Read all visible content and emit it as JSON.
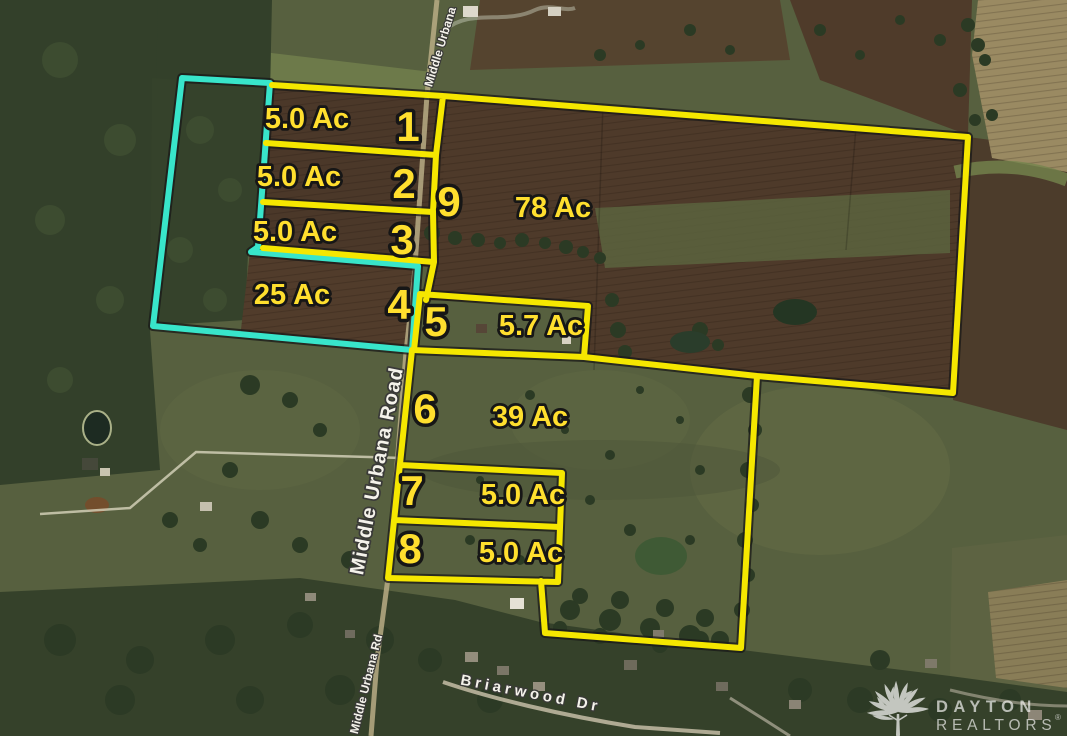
{
  "map": {
    "boundary_colors": {
      "yellow": "#f5e700",
      "cyan": "#38e5ca"
    },
    "label_colors": {
      "parcel_text": "#ffdf2e",
      "road_text": "#ffffff"
    },
    "parcels": [
      {
        "number": "1",
        "acreage": "5.0 Ac"
      },
      {
        "number": "2",
        "acreage": "5.0 Ac"
      },
      {
        "number": "3",
        "acreage": "5.0 Ac"
      },
      {
        "number": "4",
        "acreage": "25 Ac"
      },
      {
        "number": "5",
        "acreage": "5.7 Ac"
      },
      {
        "number": "6",
        "acreage": "39 Ac"
      },
      {
        "number": "7",
        "acreage": "5.0 Ac"
      },
      {
        "number": "8",
        "acreage": "5.0 Ac"
      },
      {
        "number": "9",
        "acreage": "78 Ac"
      }
    ],
    "road_labels": [
      {
        "name": "Middle Urbana"
      },
      {
        "name": "Middle Urbana Road"
      },
      {
        "name": "Middle Urbana Rd"
      },
      {
        "name": "Briarwood Dr"
      }
    ]
  },
  "watermark": {
    "brand": "DAYTON",
    "suffix": "REALTORS",
    "mark": "®"
  }
}
